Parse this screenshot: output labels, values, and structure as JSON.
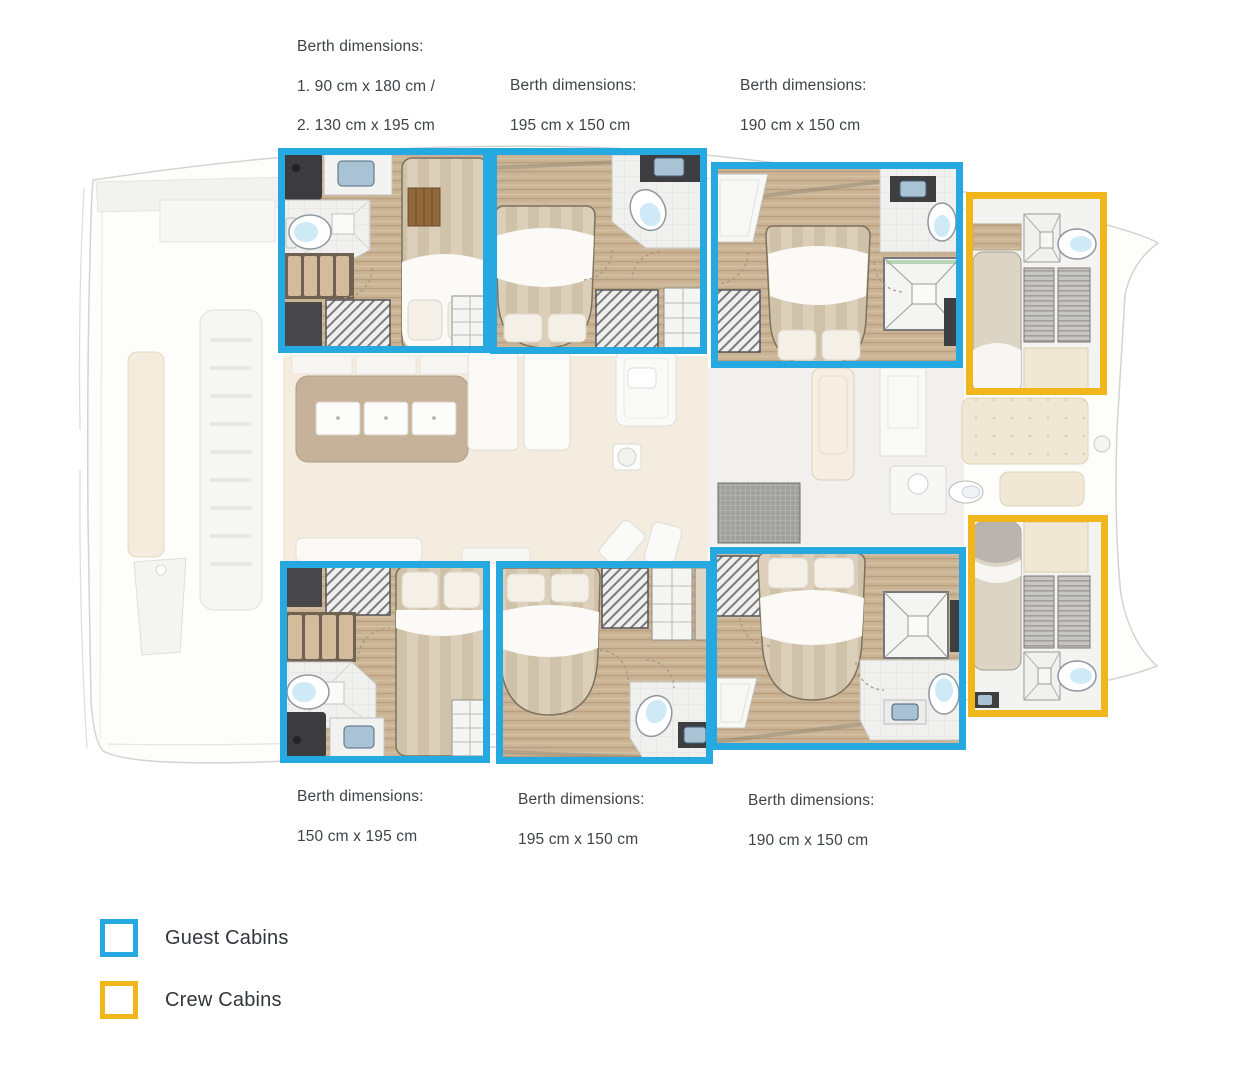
{
  "colors": {
    "guest_cabin_accent": "#25A9E0",
    "crew_cabin_accent": "#F2B61D",
    "annotation_text": "#3E4347"
  },
  "annotations": {
    "top_left": {
      "lines": [
        "Berth dimensions:",
        "1. 90 cm x 180 cm /",
        "2. 130 cm x 195 cm"
      ]
    },
    "top_middle": {
      "lines": [
        "Berth dimensions:",
        "195 cm x 150 cm"
      ]
    },
    "top_right": {
      "lines": [
        "Berth dimensions:",
        "190 cm x 150 cm"
      ]
    },
    "bottom_left": {
      "lines": [
        "Berth dimensions:",
        "150 cm x 195 cm"
      ]
    },
    "bottom_middle": {
      "lines": [
        "Berth dimensions:",
        "195 cm x 150 cm"
      ]
    },
    "bottom_right": {
      "lines": [
        "Berth dimensions:",
        "190 cm x 150 cm"
      ]
    }
  },
  "legend": {
    "items": [
      {
        "label": "Guest Cabins",
        "color": "#25A9E0"
      },
      {
        "label": "Crew Cabins",
        "color": "#F2B61D"
      }
    ]
  }
}
